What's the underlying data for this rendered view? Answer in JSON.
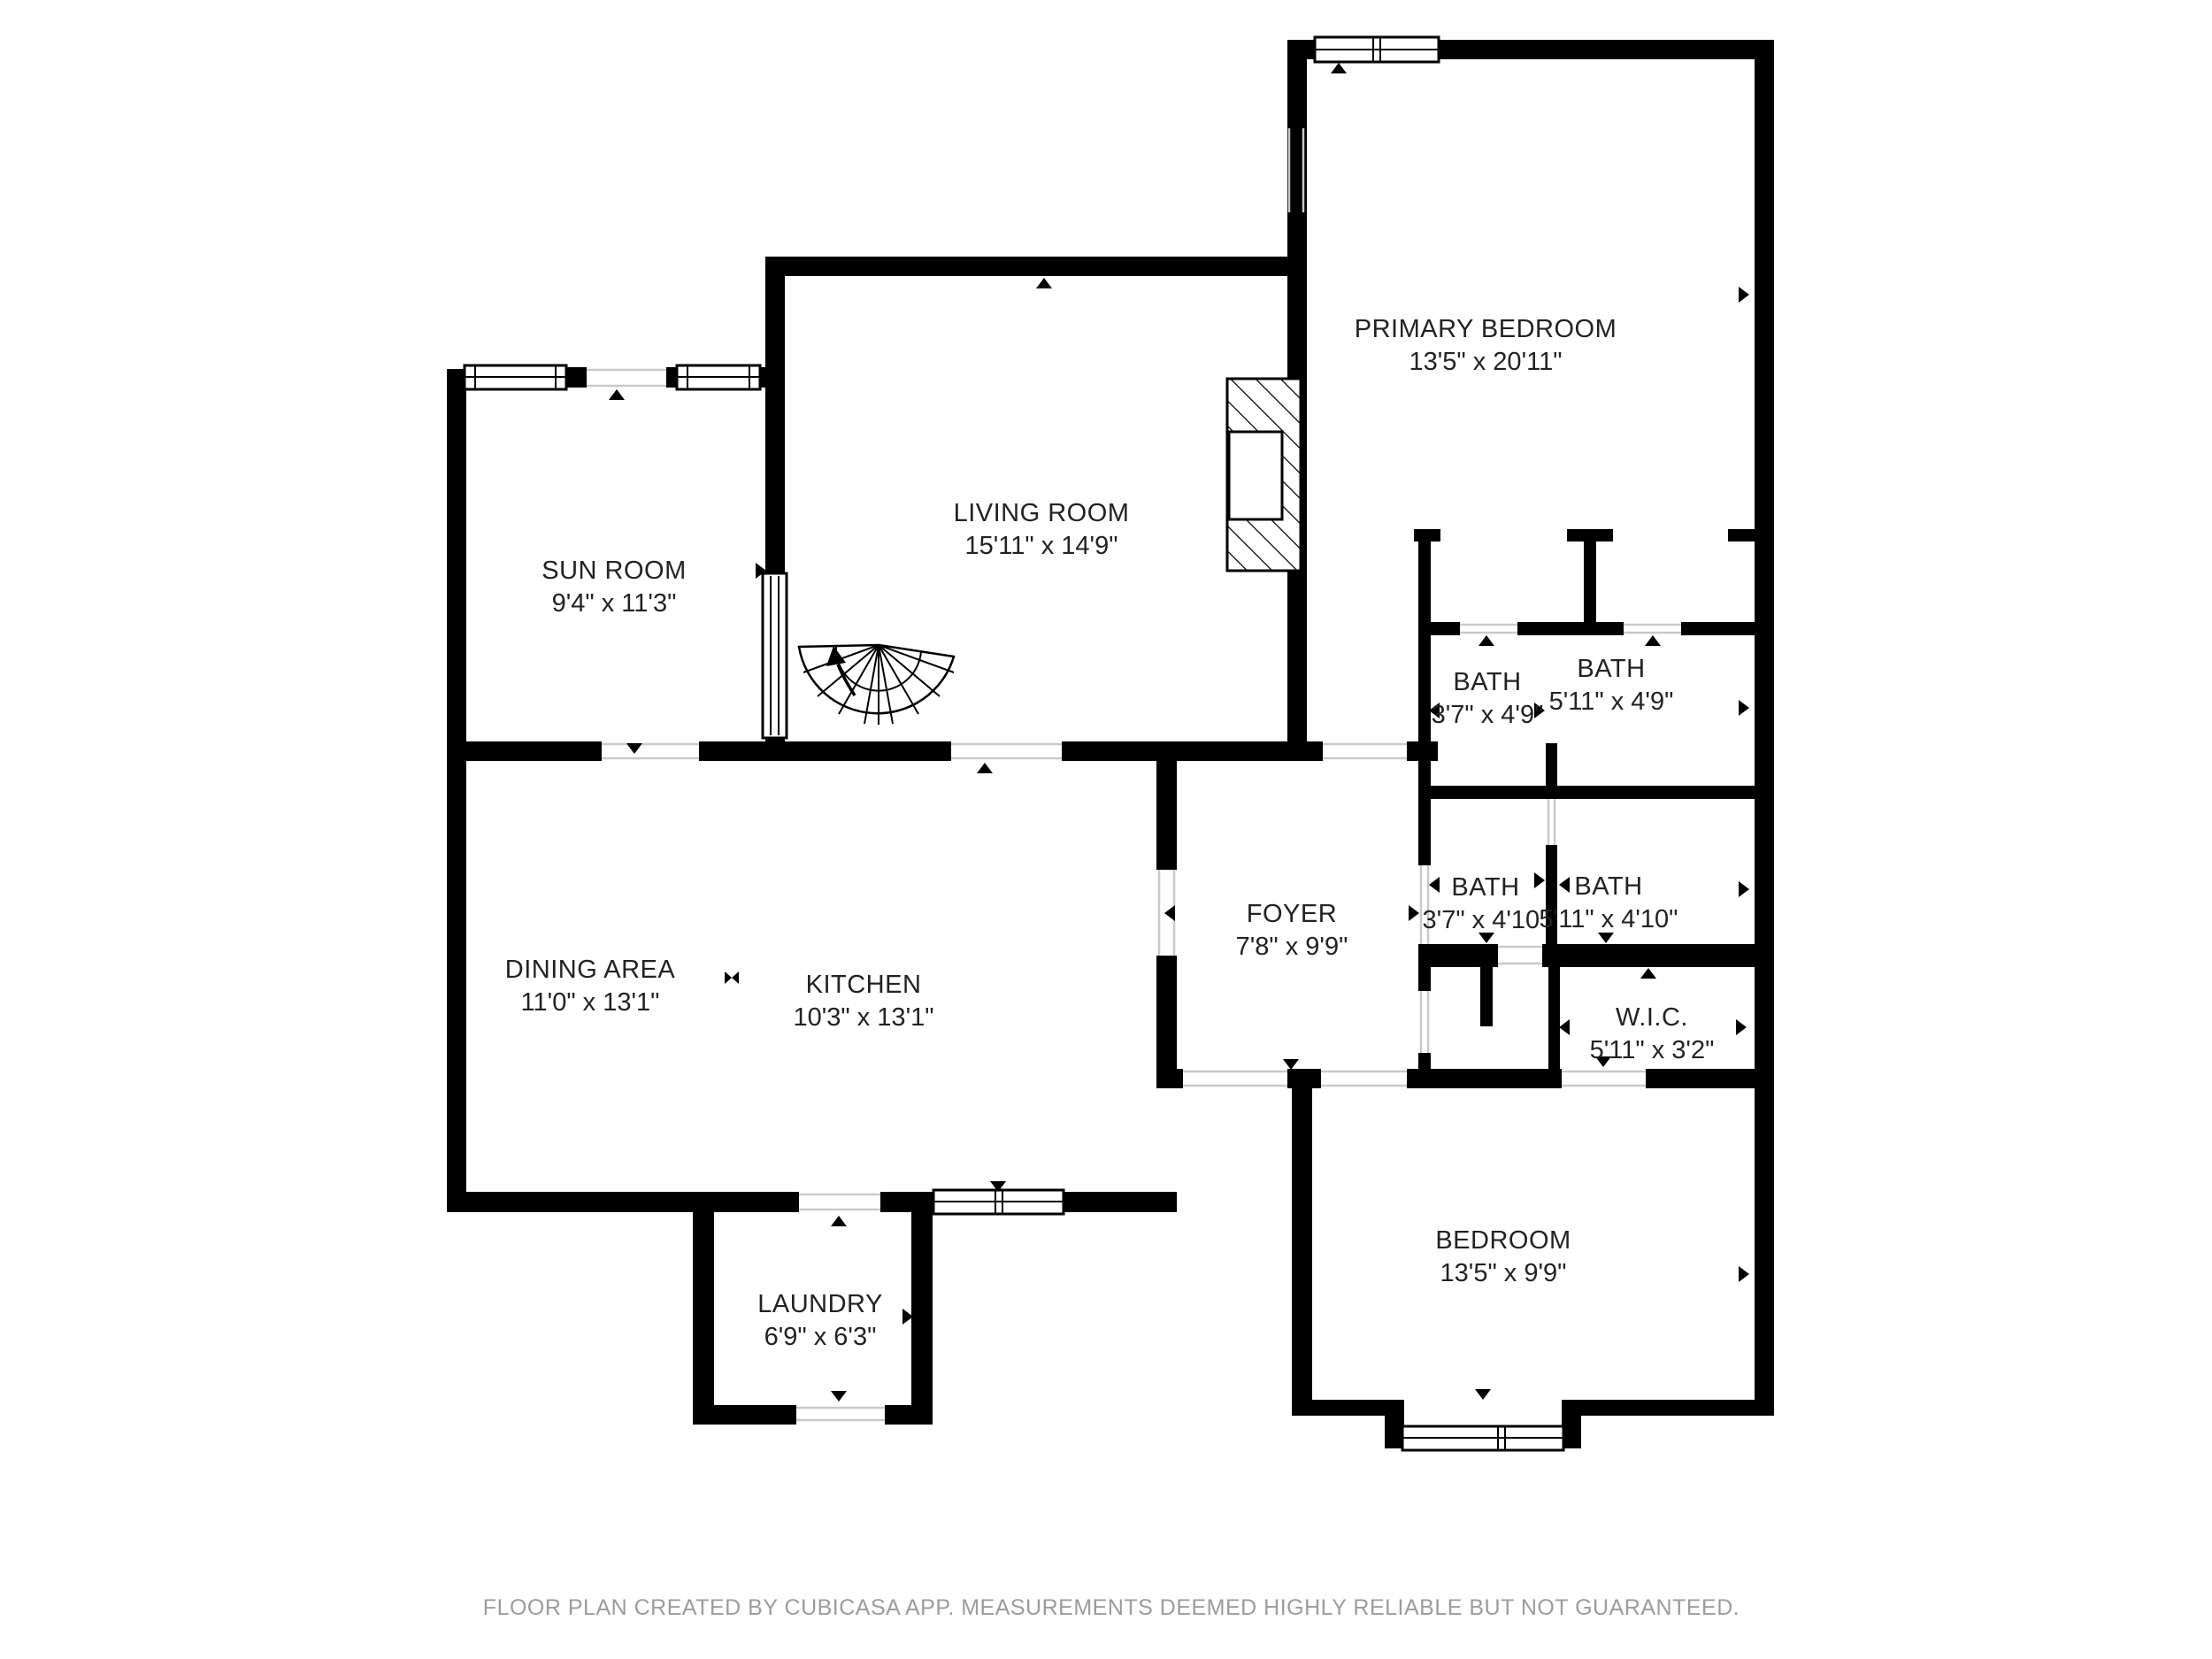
{
  "plan": {
    "rooms": [
      {
        "id": "primary-bedroom",
        "name": "PRIMARY BEDROOM",
        "dims": "13'5\" x 20'11\""
      },
      {
        "id": "sun-room",
        "name": "SUN ROOM",
        "dims": "9'4\" x 11'3\""
      },
      {
        "id": "living-room",
        "name": "LIVING ROOM",
        "dims": "15'11\" x 14'9\""
      },
      {
        "id": "bath-top-left",
        "name": "BATH",
        "dims": "3'7\" x 4'9\""
      },
      {
        "id": "bath-top-right",
        "name": "BATH",
        "dims": "5'11\" x 4'9\""
      },
      {
        "id": "bath-mid-left",
        "name": "BATH",
        "dims": "3'7\" x 4'10\""
      },
      {
        "id": "bath-mid-right",
        "name": "BATH",
        "dims": "5'11\" x 4'10\""
      },
      {
        "id": "foyer",
        "name": "FOYER",
        "dims": "7'8\" x 9'9\""
      },
      {
        "id": "dining-area",
        "name": "DINING AREA",
        "dims": "11'0\" x 13'1\""
      },
      {
        "id": "kitchen",
        "name": "KITCHEN",
        "dims": "10'3\" x 13'1\""
      },
      {
        "id": "wic",
        "name": "W.I.C.",
        "dims": "5'11\" x 3'2\""
      },
      {
        "id": "bedroom",
        "name": "BEDROOM",
        "dims": "13'5\" x 9'9\""
      },
      {
        "id": "laundry",
        "name": "LAUNDRY",
        "dims": "6'9\" x 6'3\""
      }
    ],
    "footer": "FLOOR PLAN CREATED BY CUBICASA APP. MEASUREMENTS DEEMED HIGHLY RELIABLE BUT NOT GUARANTEED.",
    "colors": {
      "wall": "#000000",
      "background": "#ffffff",
      "footer_text": "#9c9c9c"
    }
  }
}
